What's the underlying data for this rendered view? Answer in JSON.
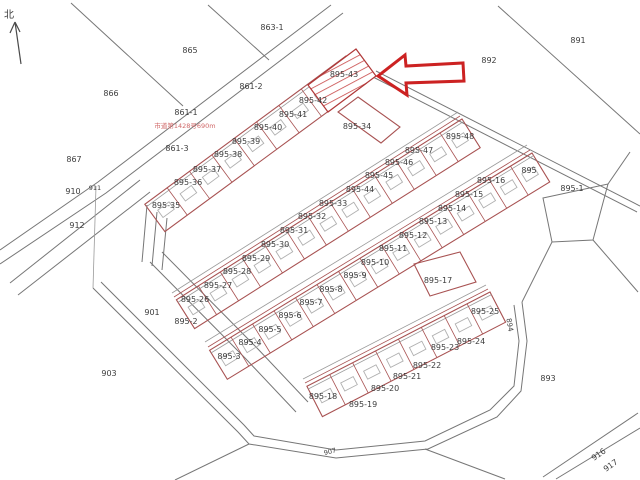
{
  "compass": {
    "label": "北"
  },
  "annotation": {
    "text": "市道第1428号690m"
  },
  "highlight": {
    "parcel": "895-43",
    "arrow_color": "#cc2222"
  },
  "colors": {
    "boundary": "#767676",
    "parcel_line": "#a85252",
    "building_line": "#b0b0b0",
    "label_text": "#3c3c3c",
    "annotation_text": "#d06868",
    "highlight_red": "#cc2222"
  },
  "area_labels": [
    {
      "label": "863-1",
      "x": 272,
      "y": 28
    },
    {
      "label": "865",
      "x": 190,
      "y": 51
    },
    {
      "label": "866",
      "x": 111,
      "y": 94
    },
    {
      "label": "891",
      "x": 578,
      "y": 41
    },
    {
      "label": "892",
      "x": 489,
      "y": 61
    },
    {
      "label": "861-2",
      "x": 251,
      "y": 87
    },
    {
      "label": "861-1",
      "x": 186,
      "y": 113
    },
    {
      "label": "861-3",
      "x": 177,
      "y": 149
    },
    {
      "label": "867",
      "x": 74,
      "y": 160
    },
    {
      "label": "910",
      "x": 73,
      "y": 192
    },
    {
      "label": "911",
      "x": 95,
      "y": 188,
      "size": 6.5
    },
    {
      "label": "912",
      "x": 77,
      "y": 226
    },
    {
      "label": "901",
      "x": 152,
      "y": 313
    },
    {
      "label": "895-2",
      "x": 186,
      "y": 322
    },
    {
      "label": "903",
      "x": 109,
      "y": 374
    },
    {
      "label": "893",
      "x": 548,
      "y": 379
    },
    {
      "label": "894",
      "x": 509,
      "y": 325,
      "rot": 80,
      "size": 7
    },
    {
      "label": "907",
      "x": 330,
      "y": 452,
      "rot": -15,
      "size": 6.5
    },
    {
      "label": "916",
      "x": 599,
      "y": 455,
      "rot": -35
    },
    {
      "label": "917",
      "x": 611,
      "y": 466,
      "rot": -35
    },
    {
      "label": "895-1",
      "x": 572,
      "y": 189
    },
    {
      "label": "895-34",
      "x": 357,
      "y": 127
    },
    {
      "label": "895-17",
      "x": 438,
      "y": 281
    }
  ],
  "strips": [
    {
      "name": "row-1",
      "p0": [
        346,
        56
      ],
      "dir": [
        -0.805,
        0.593
      ],
      "len": 250,
      "width": 34,
      "cells": [
        {
          "label": "895-43",
          "x": 344,
          "y": 75
        },
        {
          "label": "895-42",
          "x": 313,
          "y": 101
        },
        {
          "label": "895-41",
          "x": 293,
          "y": 115
        },
        {
          "label": "895-40",
          "x": 268,
          "y": 128
        },
        {
          "label": "895-39",
          "x": 246,
          "y": 142
        },
        {
          "label": "895-38",
          "x": 228,
          "y": 155
        },
        {
          "label": "895-37",
          "x": 207,
          "y": 170
        },
        {
          "label": "895-36",
          "x": 188,
          "y": 183
        },
        {
          "label": "895-35",
          "x": 166,
          "y": 206
        }
      ]
    },
    {
      "name": "row-2",
      "p0": [
        462,
        119
      ],
      "dir": [
        -0.845,
        0.535
      ],
      "len": 338,
      "width": 34,
      "cells": [
        {
          "label": "895-48",
          "x": 460,
          "y": 137
        },
        {
          "label": "895-47",
          "x": 419,
          "y": 151
        },
        {
          "label": "895-46",
          "x": 399,
          "y": 163
        },
        {
          "label": "895-45",
          "x": 379,
          "y": 176
        },
        {
          "label": "895-44",
          "x": 360,
          "y": 190
        },
        {
          "label": "895-33",
          "x": 333,
          "y": 204
        },
        {
          "label": "895-32",
          "x": 312,
          "y": 217
        },
        {
          "label": "895-31",
          "x": 294,
          "y": 231
        },
        {
          "label": "895-30",
          "x": 275,
          "y": 245
        },
        {
          "label": "895-29",
          "x": 256,
          "y": 259
        },
        {
          "label": "895-28",
          "x": 237,
          "y": 272
        },
        {
          "label": "895-27",
          "x": 218,
          "y": 286
        },
        {
          "label": "895-26",
          "x": 195,
          "y": 300
        }
      ]
    },
    {
      "name": "row-3",
      "p0": [
        532,
        153
      ],
      "dir": [
        -0.853,
        0.522
      ],
      "len": 378,
      "width": 34,
      "cells": [
        {
          "label": "895",
          "x": 529,
          "y": 171
        },
        {
          "label": "895-16",
          "x": 491,
          "y": 181
        },
        {
          "label": "895-15",
          "x": 469,
          "y": 195
        },
        {
          "label": "895-14",
          "x": 452,
          "y": 209
        },
        {
          "label": "895-13",
          "x": 433,
          "y": 222
        },
        {
          "label": "895-12",
          "x": 413,
          "y": 236
        },
        {
          "label": "895-11",
          "x": 393,
          "y": 249
        },
        {
          "label": "895-10",
          "x": 375,
          "y": 263
        },
        {
          "label": "895-9",
          "x": 355,
          "y": 276
        },
        {
          "label": "895-8",
          "x": 331,
          "y": 290
        },
        {
          "label": "895-7",
          "x": 311,
          "y": 303
        },
        {
          "label": "895-6",
          "x": 290,
          "y": 316
        },
        {
          "label": "895-5",
          "x": 270,
          "y": 330
        },
        {
          "label": "895-4",
          "x": 250,
          "y": 343
        },
        {
          "label": "895-3",
          "x": 229,
          "y": 357
        }
      ]
    },
    {
      "name": "row-4",
      "p0": [
        490,
        292
      ],
      "dir": [
        -0.889,
        0.458
      ],
      "len": 206,
      "width": 34,
      "cells": [
        {
          "label": "895-25",
          "x": 485,
          "y": 312
        },
        {
          "label": "895-24",
          "x": 471,
          "y": 342
        },
        {
          "label": "895-23",
          "x": 445,
          "y": 348
        },
        {
          "label": "895-22",
          "x": 427,
          "y": 366
        },
        {
          "label": "895-21",
          "x": 407,
          "y": 377
        },
        {
          "label": "895-20",
          "x": 385,
          "y": 389
        },
        {
          "label": "895-19",
          "x": 363,
          "y": 405
        },
        {
          "label": "895-18",
          "x": 323,
          "y": 397
        }
      ]
    }
  ]
}
